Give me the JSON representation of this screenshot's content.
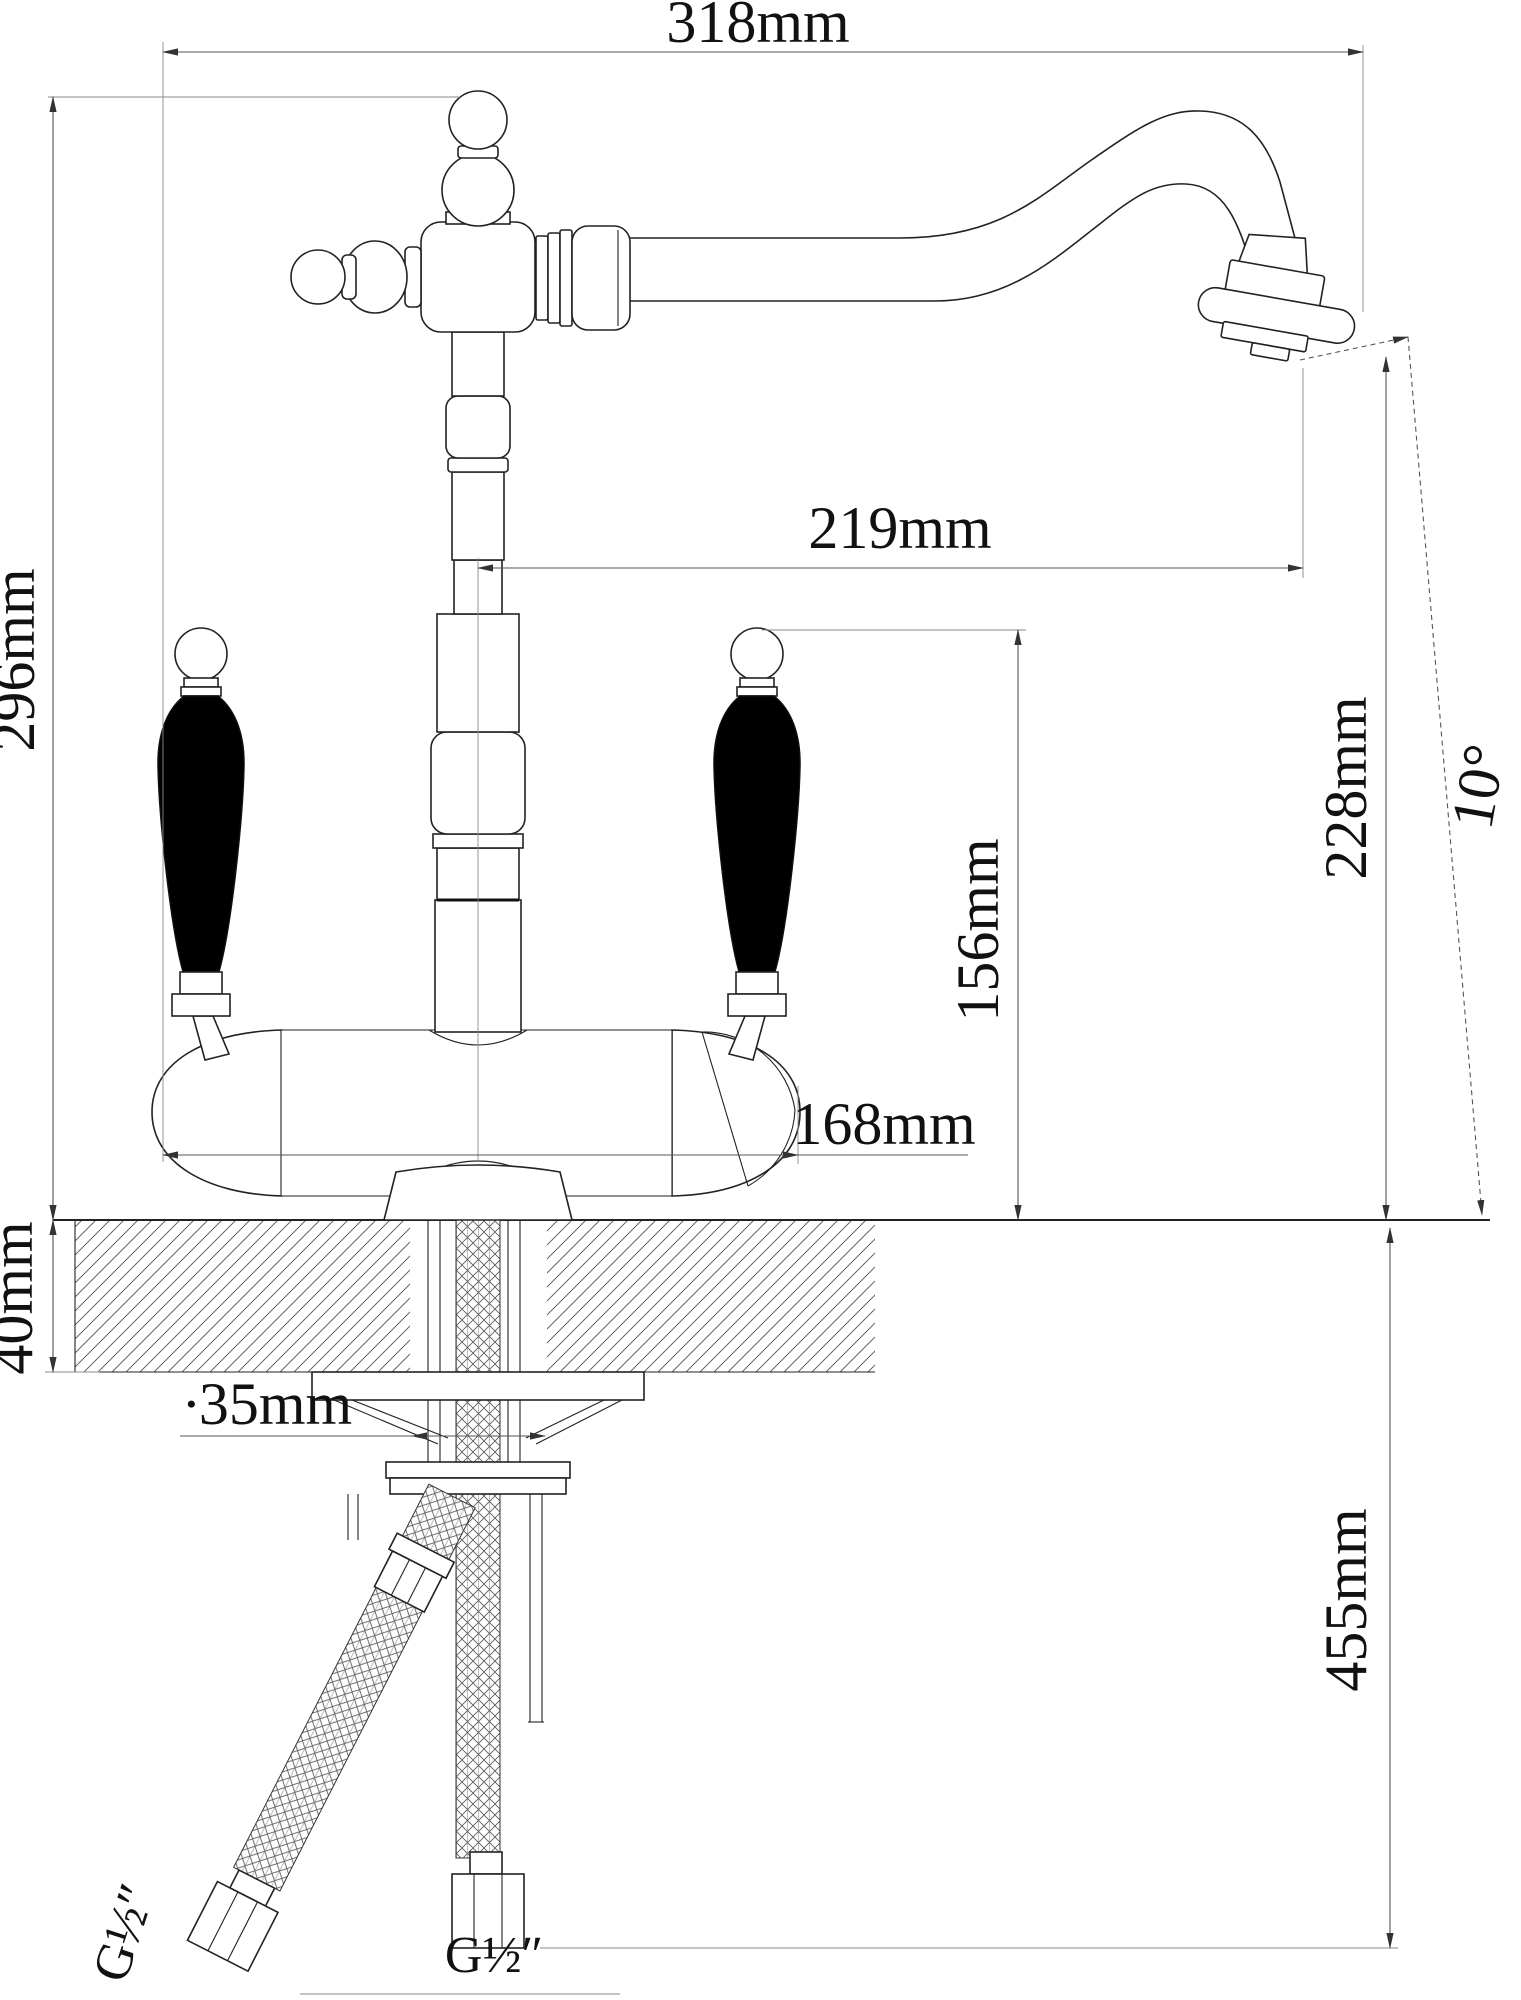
{
  "drawing": {
    "type": "technical-dimension-drawing",
    "subject": "classic two-handle kitchen mixer faucet, front elevation with installation dimensions",
    "background": "#ffffff",
    "line_color": "#222222",
    "dimension_color": "#555555",
    "handle_fill": "#000000"
  },
  "dimensions": {
    "overall_width": "318mm",
    "overall_height": "296mm",
    "spout_reach": "219mm",
    "spout_outlet_height": "228mm",
    "aerator_angle": "10°",
    "handle_height": "156mm",
    "body_width": "168mm",
    "mount_thickness": "40mm",
    "hole_diameter": "∙35mm",
    "hose_length": "455mm",
    "supply_thread": "G½″",
    "filter_thread": "G½″"
  }
}
